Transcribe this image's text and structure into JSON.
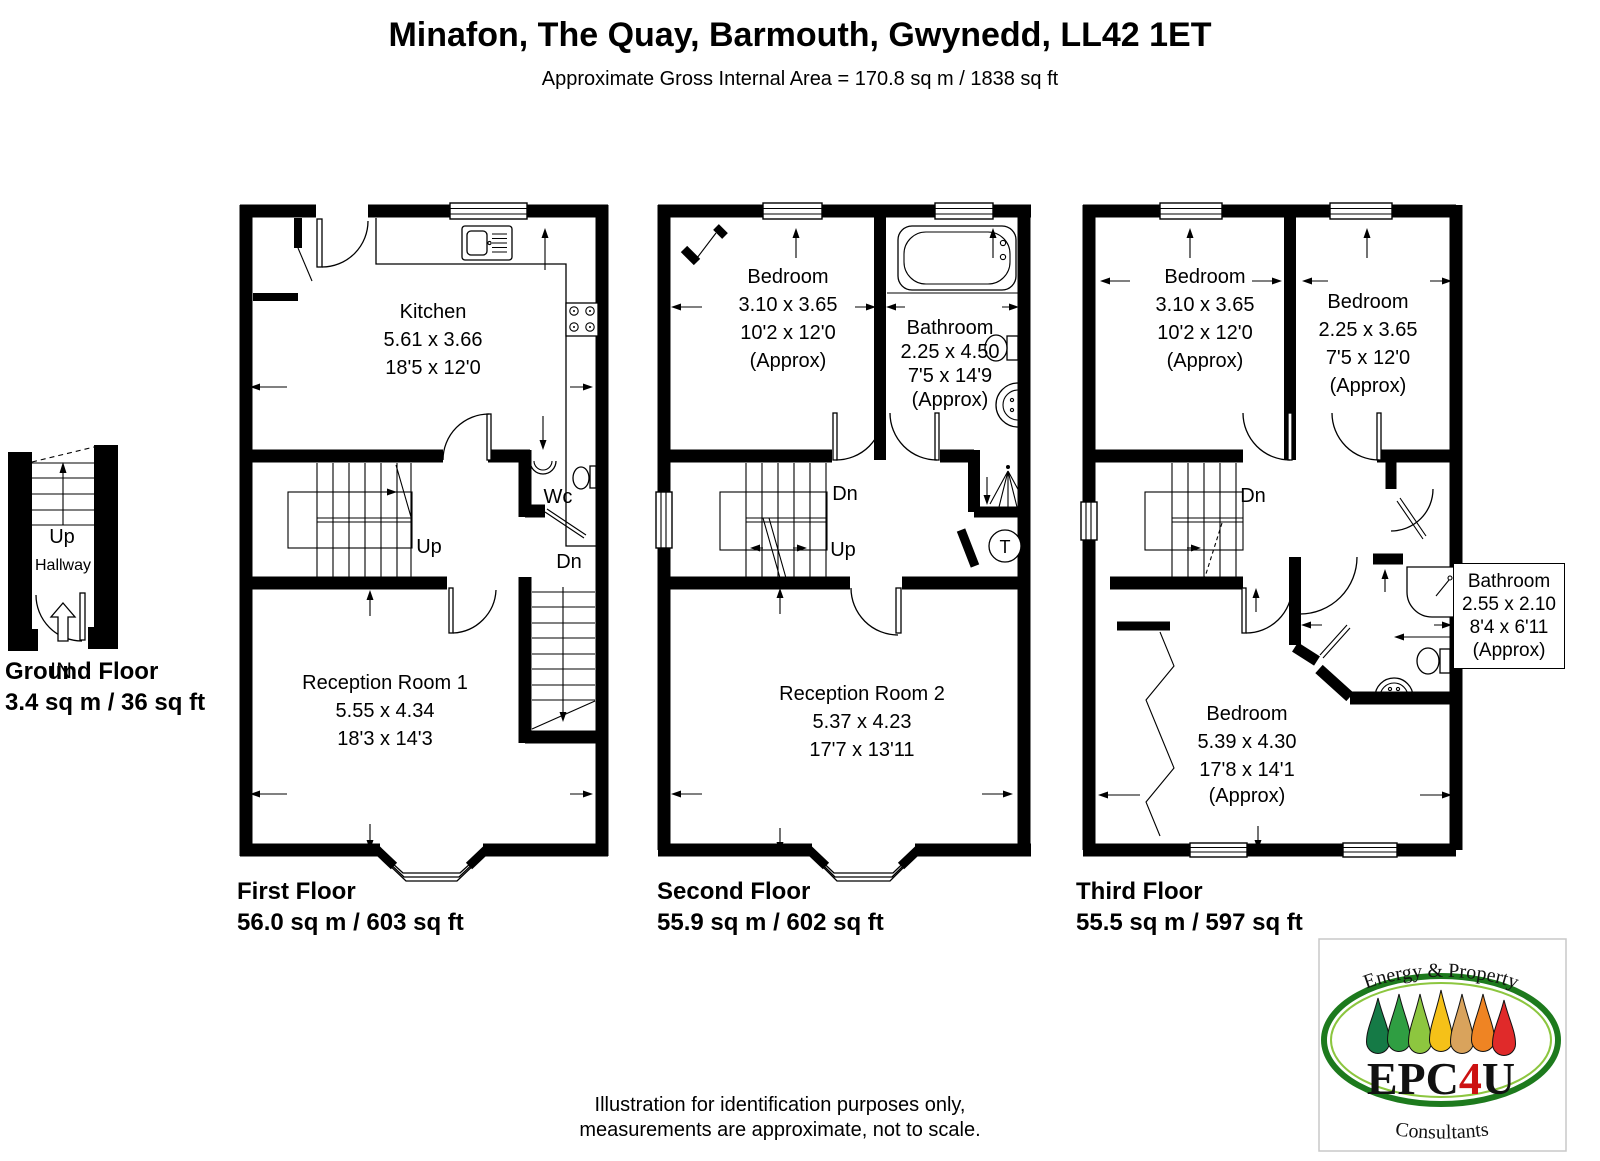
{
  "header": {
    "title": "Minafon, The Quay, Barmouth, Gwynedd, LL42 1ET",
    "subtitle": "Approximate Gross Internal Area = 170.8 sq m / 1838 sq ft"
  },
  "floors": {
    "ground": {
      "name": "Ground Floor",
      "area": "3.4 sq m / 36 sq ft",
      "labels": {
        "up": "Up",
        "hallway": "Hallway",
        "entrance": "IN"
      }
    },
    "first": {
      "name": "First Floor",
      "area": "56.0 sq m / 603 sq ft",
      "labels": {
        "up": "Up",
        "dn": "Dn"
      },
      "rooms": {
        "kitchen": {
          "name": "Kitchen",
          "metric": "5.61 x 3.66",
          "imperial": "18'5 x 12'0"
        },
        "wc": {
          "name": "Wc"
        },
        "reception1": {
          "name": "Reception Room 1",
          "metric": "5.55 x 4.34",
          "imperial": "18'3 x 14'3"
        }
      }
    },
    "second": {
      "name": "Second Floor",
      "area": "55.9 sq m / 602 sq ft",
      "labels": {
        "up": "Up",
        "dn": "Dn",
        "tank": "T"
      },
      "rooms": {
        "bedroom": {
          "name": "Bedroom",
          "metric": "3.10 x 3.65",
          "imperial": "10'2 x 12'0",
          "approx": "(Approx)"
        },
        "bathroom": {
          "name": "Bathroom",
          "metric": "2.25 x 4.50",
          "imperial": "7'5 x 14'9",
          "approx": "(Approx)"
        },
        "reception2": {
          "name": "Reception Room 2",
          "metric": "5.37 x 4.23",
          "imperial": "17'7 x 13'11"
        }
      }
    },
    "third": {
      "name": "Third Floor",
      "area": "55.5 sq m / 597 sq ft",
      "labels": {
        "dn": "Dn"
      },
      "rooms": {
        "bedroom1": {
          "name": "Bedroom",
          "metric": "3.10 x 3.65",
          "imperial": "10'2 x 12'0",
          "approx": "(Approx)"
        },
        "bedroom2": {
          "name": "Bedroom",
          "metric": "2.25 x 3.65",
          "imperial": "7'5 x 12'0",
          "approx": "(Approx)"
        },
        "bedroom3": {
          "name": "Bedroom",
          "metric": "5.39 x 4.30",
          "imperial": "17'8 x 14'1",
          "approx": "(Approx)"
        },
        "bathroom": {
          "name": "Bathroom",
          "metric": "2.55 x 2.10",
          "imperial": "8'4 x 6'11",
          "approx": "(Approx)"
        }
      }
    }
  },
  "footer": {
    "line1": "Illustration for identification purposes only,",
    "line2": "measurements are approximate, not to scale."
  },
  "logo": {
    "top": "Energy & Property",
    "center_epc": "EPC",
    "center_4": "4",
    "center_u": "U",
    "bottom": "Consultants",
    "accent_red": "#cc1111",
    "ellipse_green": "#1d7a1d",
    "ellipse_light_green": "#8cc63f",
    "drop_colors": [
      "#157a46",
      "#2f9e42",
      "#8dc63f",
      "#f5c118",
      "#d9a35c",
      "#ef8423",
      "#e02a2a"
    ]
  }
}
